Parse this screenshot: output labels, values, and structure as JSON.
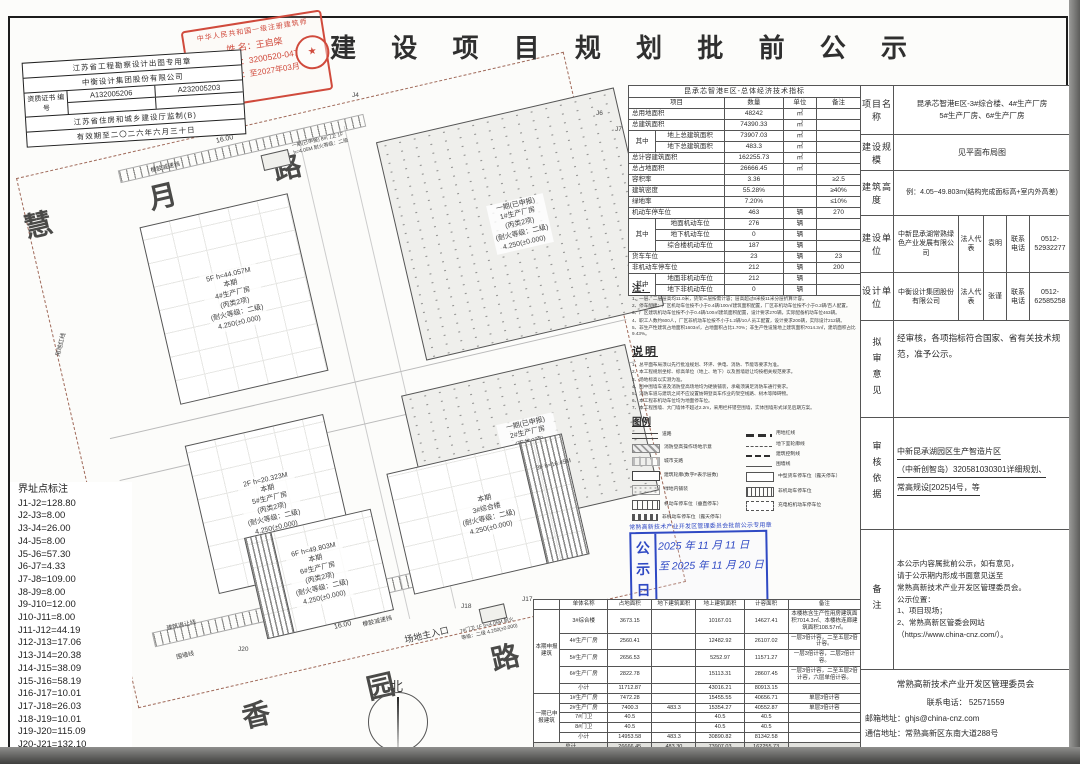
{
  "title": "建 设 项 目 规 划 批 前 公 示",
  "stamps": {
    "architect": {
      "line1": "中华人民共和国一级注册建筑师",
      "name": "姓 名：王启棨",
      "reg": "注册号：3200520-047",
      "valid": "有效期：至2027年03月",
      "seal_glyph": "★"
    },
    "design_firm": {
      "row1": "江苏省工程勘察设计出图专用章",
      "row2": "中衡设计集团股份有限公司",
      "cert_label": "资质证书 编号",
      "cert1": "A132005206",
      "cert2": "A232005203",
      "row4": "江苏省住房和城乡建设厅监制(B)",
      "row5": "有效期至二〇二六年六月三十日"
    },
    "notice": {
      "arc": "常熟高新技术产业开发区管理委员会批前公示专用章",
      "label_line1": "公 示",
      "label_line2": "日 期",
      "date_line1": "2025 年 11 月 11 日",
      "date_line2": "至 2025 年 11 月 20 日"
    }
  },
  "siteplan": {
    "road_top": "慧 月 路",
    "road_bottom": "香 园 路",
    "entrance_top": "场地次入口",
    "entrance_bottom": "场地主入口",
    "dim_top": "16.00",
    "dim_bottom": "16.00",
    "speed_bump_top": "橡胶减速挡",
    "speed_bump_bottom": "橡胶减速挡",
    "north": "北",
    "setback_label": "建筑退让线",
    "fence_label": "围墙线",
    "redline_label": "用地红线",
    "guard7": "7#门卫 1F h=4.05M 耐火等级：二级 4.250(±0.000)",
    "guard8": "一期(已申报) 8#门卫 1F h=4.05M 耐火等级：二级",
    "buildings": [
      {
        "id": "b4",
        "lines": [
          "5F  h=44.057M",
          "本期",
          "4#生产厂房",
          "(丙类2项)",
          "(耐火等级：二级)",
          "4.250(±0.000)"
        ],
        "hatched": false
      },
      {
        "id": "b1",
        "lines": [
          "一期(已申报)",
          "1#生产厂房",
          "(丙类2项)",
          "(耐火等级：二级)",
          "4.250(±0.000)"
        ],
        "hatched": true
      },
      {
        "id": "b2",
        "lines": [
          "一期(已申报)",
          "2#生产厂房",
          "(丙类2项)",
          "(耐火等级：二级)",
          "4.250(±0.000)"
        ],
        "hatched": true
      },
      {
        "id": "b5",
        "lines": [
          "2F  h=20.323M",
          "本期",
          "5#生产厂房",
          "(丙类2项)",
          "(耐火等级：二级)",
          "4.250(±0.000)"
        ],
        "hatched": false
      },
      {
        "id": "b6",
        "lines": [
          "6F  h=49.803M",
          "本期",
          "6#生产厂房",
          "(丙类2项)",
          "(耐火等级：二级)",
          "4.250(±0.000)"
        ],
        "hatched": false
      },
      {
        "id": "b3",
        "lines": [
          "本期",
          "3#综合楼",
          "(耐火等级：二级)",
          "4.250(±0.000)"
        ],
        "hatched": false
      },
      {
        "id": "b3w",
        "lines": [
          "3F h=16.45M"
        ],
        "hatched": true
      }
    ],
    "jpoints": [
      "J4",
      "J6",
      "J7",
      "J8",
      "J17",
      "J18",
      "J20",
      "J21"
    ],
    "coords": {
      "title": "界址点标注",
      "items": [
        "J1-J2=128.80",
        "J2-J3=8.00",
        "J3-J4=26.00",
        "J4-J5=8.00",
        "J5-J6=57.30",
        "J6-J7=4.33",
        "J7-J8=109.00",
        "J8-J9=8.00",
        "J9-J10=12.00",
        "J10-J11=8.00",
        "J11-J12=44.19",
        "J12-J13=17.06",
        "J13-J14=20.38",
        "J14-J15=38.09",
        "J15-J16=58.19",
        "J16-J17=10.01",
        "J17-J18=26.03",
        "J18-J19=10.01",
        "J19-J20=115.09",
        "J20-J21=132.10",
        "J21-J1=104.06"
      ]
    }
  },
  "indicators": {
    "title": "昆承芯智港E区-总体经济技术指标",
    "headers": [
      "项目",
      "数量",
      "单位",
      "备注"
    ],
    "rows": [
      [
        "总用地面积",
        "",
        "48242",
        "㎡",
        ""
      ],
      [
        "总建筑面积",
        "",
        "74390.33",
        "㎡",
        ""
      ],
      [
        "其中",
        "地上总建筑面积",
        "73907.03",
        "㎡",
        ""
      ],
      [
        "",
        "地下总建筑面积",
        "483.3",
        "㎡",
        ""
      ],
      [
        "总计容建筑面积",
        "",
        "162255.73",
        "㎡",
        ""
      ],
      [
        "总占地面积",
        "",
        "26666.45",
        "㎡",
        ""
      ],
      [
        "容积率",
        "",
        "3.36",
        "",
        "≥2.5"
      ],
      [
        "建筑密度",
        "",
        "55.28%",
        "",
        "≥40%"
      ],
      [
        "绿地率",
        "",
        "7.20%",
        "",
        "≤10%"
      ],
      [
        "机动车停车位",
        "",
        "463",
        "辆",
        "270"
      ],
      [
        "其中",
        "地面机动车位",
        "276",
        "辆",
        ""
      ],
      [
        "",
        "地下机动车位",
        "0",
        "辆",
        ""
      ],
      [
        "",
        "综合楼机动车位",
        "187",
        "辆",
        ""
      ],
      [
        "货车车位",
        "",
        "23",
        "辆",
        "23"
      ],
      [
        "非机动车停车位",
        "",
        "212",
        "辆",
        "200"
      ],
      [
        "其中",
        "地面非机动车位",
        "212",
        "辆",
        ""
      ],
      [
        "",
        "地下非机动车位",
        "0",
        "辆",
        ""
      ]
    ]
  },
  "notes": {
    "title": "注：",
    "lines": [
      "1、一层、二层层高均11.0米，货架三层按需计容；层高超过8米按11米分层折算计容。",
      "2、停车配建：厂区机动车位按不小于0.4辆/100㎡建筑面积配置，厂区非机动车位按不小于0.2辆/百人配置。",
      "3、厂区建筑机动车位按不小于0.4辆/100㎡建筑面积配置，设计要求270辆，实际配备机动车位463辆。",
      "4、职工人数约600人，厂区非机动车位按不小于1.2辆/10人员工配置，设计要求200辆，实际设计212辆。",
      "5、非生产性建筑占地面积1603㎡，占地面积占比1.70%；非生产性设施地上建筑面积7014.3㎡，建筑面积占比9.43%。"
    ]
  },
  "description": {
    "title": "说明",
    "lines": [
      "1、总平面布局须以先行批准规划、环评、供电、消防、节能等要求为准。",
      "2、本工程规划坐标、标高单位（地上、地下）以及围墙退让均按相关规范要求。",
      "3、场地标高以实测为准。",
      "4、图中围墙车道及消防登高场地均为硬质铺装，承载须满足消防车通行要求。",
      "5、消防车道与建筑之间不应设置妨碍登高车作业的架空线路、树木等障碍物。",
      "6、本工程非机动车位均为地面停车位。",
      "7、本工程围墙、大门墙体不超过2.2m，采用栏杆镂空围墙，实体围墙形式详见后期方案。"
    ]
  },
  "legend": {
    "title": "图例",
    "left": [
      {
        "sym": "road",
        "label": "道路"
      },
      {
        "sym": "fire",
        "label": "消防登高操作场地示意"
      },
      {
        "sym": "city",
        "label": "城市支路"
      },
      {
        "sym": "outline",
        "label": "建筑轮廓(数字F表示层数)"
      },
      {
        "sym": "green",
        "label": "绿地内铺装"
      },
      {
        "sym": "parking",
        "label": "机动车停车位（垂直停车）"
      },
      {
        "sym": "parking2",
        "label": "非机动车停车位（露天停车）"
      }
    ],
    "right": [
      {
        "sym": "redline",
        "label": "用地红线"
      },
      {
        "sym": "basement",
        "label": "地下室轮廓线"
      },
      {
        "sym": "control",
        "label": "建筑控制线"
      },
      {
        "sym": "fence",
        "label": "围墙线"
      },
      {
        "sym": "truck",
        "label": "中型货车停车位（露天停车）"
      },
      {
        "sym": "bike",
        "label": "非机动车停车位"
      },
      {
        "sym": "charge",
        "label": "充电桩机动车停车位"
      }
    ]
  },
  "unit_table": {
    "headers": [
      "单体名称",
      "占地面积",
      "地下建筑面积",
      "地上建筑面积",
      "计容面积",
      "备注"
    ],
    "groups": [
      {
        "name": "本期申报建筑",
        "rows": [
          [
            "3#综合楼",
            "3673.15",
            "",
            "10167.01",
            "14627.41",
            "本楼栋含生产性用房建筑面积7014.3㎡、本楼栋连廊建筑面积108.57㎡。"
          ],
          [
            "4#生产厂房",
            "2560.41",
            "",
            "12482.92",
            "26107.02",
            "一层3倍计容，二至五层2倍计容。"
          ],
          [
            "5#生产厂房",
            "2656.53",
            "",
            "5252.97",
            "11571.27",
            "一层3倍计容，二层2倍计容。"
          ],
          [
            "6#生产厂房",
            "2822.78",
            "",
            "15113.31",
            "28607.45",
            "一层3倍计容，二至五层2倍计容，六层单倍计容。"
          ],
          [
            "小计",
            "11712.87",
            "",
            "43016.21",
            "80913.15",
            ""
          ]
        ]
      },
      {
        "name": "一期已申报建筑",
        "rows": [
          [
            "1#生产厂房",
            "7472.28",
            "",
            "15455.55",
            "40656.71",
            "单层3倍计容"
          ],
          [
            "2#生产厂房",
            "7400.3",
            "483.3",
            "15354.27",
            "40552.87",
            "单层3倍计容"
          ],
          [
            "7#门卫",
            "40.5",
            "",
            "40.5",
            "40.5",
            ""
          ],
          [
            "8#门卫",
            "40.5",
            "",
            "40.5",
            "40.5",
            ""
          ],
          [
            "小计",
            "14953.58",
            "483.3",
            "30890.82",
            "81342.58",
            ""
          ]
        ]
      }
    ],
    "total": [
      "总计",
      "26666.45",
      "483.30",
      "73907.03",
      "162255.73",
      ""
    ]
  },
  "right_panel": {
    "project_name_label": "项目名称",
    "project_name_line1": "昆承芯智港E区-3#综合楼、4#生产厂房",
    "project_name_line2": "5#生产厂房、6#生产厂房",
    "scale_label": "建设规模",
    "scale": "见平面布局图",
    "height_label": "建筑高度",
    "height": "例：4.05~49.803m(结构完成面标高+室内外高差)",
    "builder_label": "建设单位",
    "builder": "中新昆承湖常熟绿色产业发展有限公司",
    "builder_rep_label": "法人代表",
    "builder_rep": "袁明",
    "builder_tel_label": "联系电话",
    "builder_tel": "0512-52932277",
    "designer_label": "设计单位",
    "designer": "中衡设计集团股份有限公司",
    "designer_rep_label": "法人代表",
    "designer_rep": "张谨",
    "designer_tel_label": "联系电话",
    "designer_tel": "0512-62585258",
    "opinion_label": "拟审意见",
    "opinion": "经审核，各项指标符合国家、省有关技术规范，准予公示。",
    "basis_label": "审核依据",
    "basis_lines": [
      "中新昆承湖园区生产智造片区",
      "（中新创智岛）320581030301详细规划、",
      "常高规设[2025]4号，等"
    ],
    "remark_label": "备注",
    "remark_lines": [
      "本公示内容属批前公示，如有意见，",
      "请于公示期内形成书面意见送至",
      "常熟高新技术产业开发区管理委员会。",
      "公示位置：",
      "1、项目现场；",
      "2、常熟高新区管委会网站",
      "（https://www.china-cnz.com/）。"
    ],
    "footer_org": "常熟高新技术产业开发区管理委员会",
    "footer_tel_label": "联系电话：",
    "footer_tel": "52571559",
    "footer_mail_label": "邮箱地址：",
    "footer_mail": "ghjs@china-cnz.com",
    "footer_addr_label": "通信地址：",
    "footer_addr": "常熟高新区东南大道288号"
  }
}
